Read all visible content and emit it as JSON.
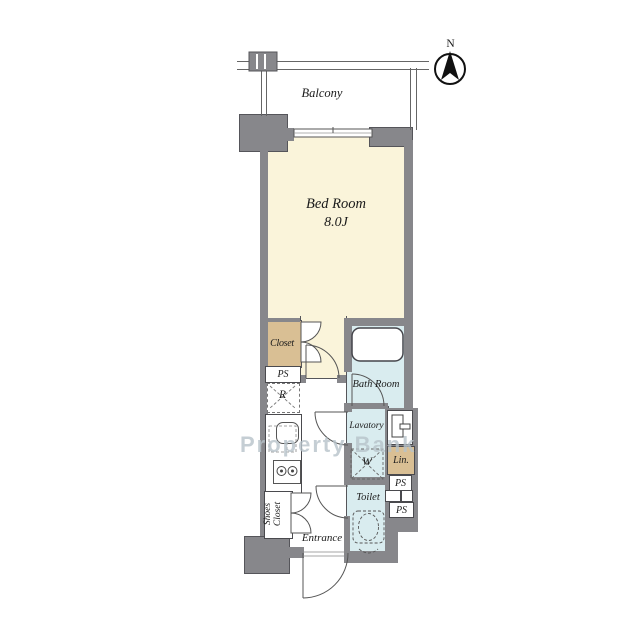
{
  "watermark": "Property Bank",
  "compass": {
    "label": "N"
  },
  "rooms": {
    "balcony": "Balcony",
    "bedroom_name": "Bed Room",
    "bedroom_size": "8.0J",
    "closet": "Closet",
    "bathroom": "Bath Room",
    "lavatory": "Lavatory",
    "toilet": "Toilet",
    "entrance": "Entrance",
    "shoes_line1": "Shoes",
    "shoes_line2": "Closet",
    "linen": "Lin.",
    "washer": "W",
    "refrigerator": "R",
    "ps_top": "PS",
    "ps_mid": "PS",
    "ps_bottom": "PS"
  },
  "colors": {
    "wall": "#87878b",
    "bedroom_floor": "#faf4da",
    "closet_floor": "#d9bf94",
    "wet_room_floor": "#d9ecef",
    "outline": "#55555a",
    "watermark": "#b7c3ca"
  }
}
